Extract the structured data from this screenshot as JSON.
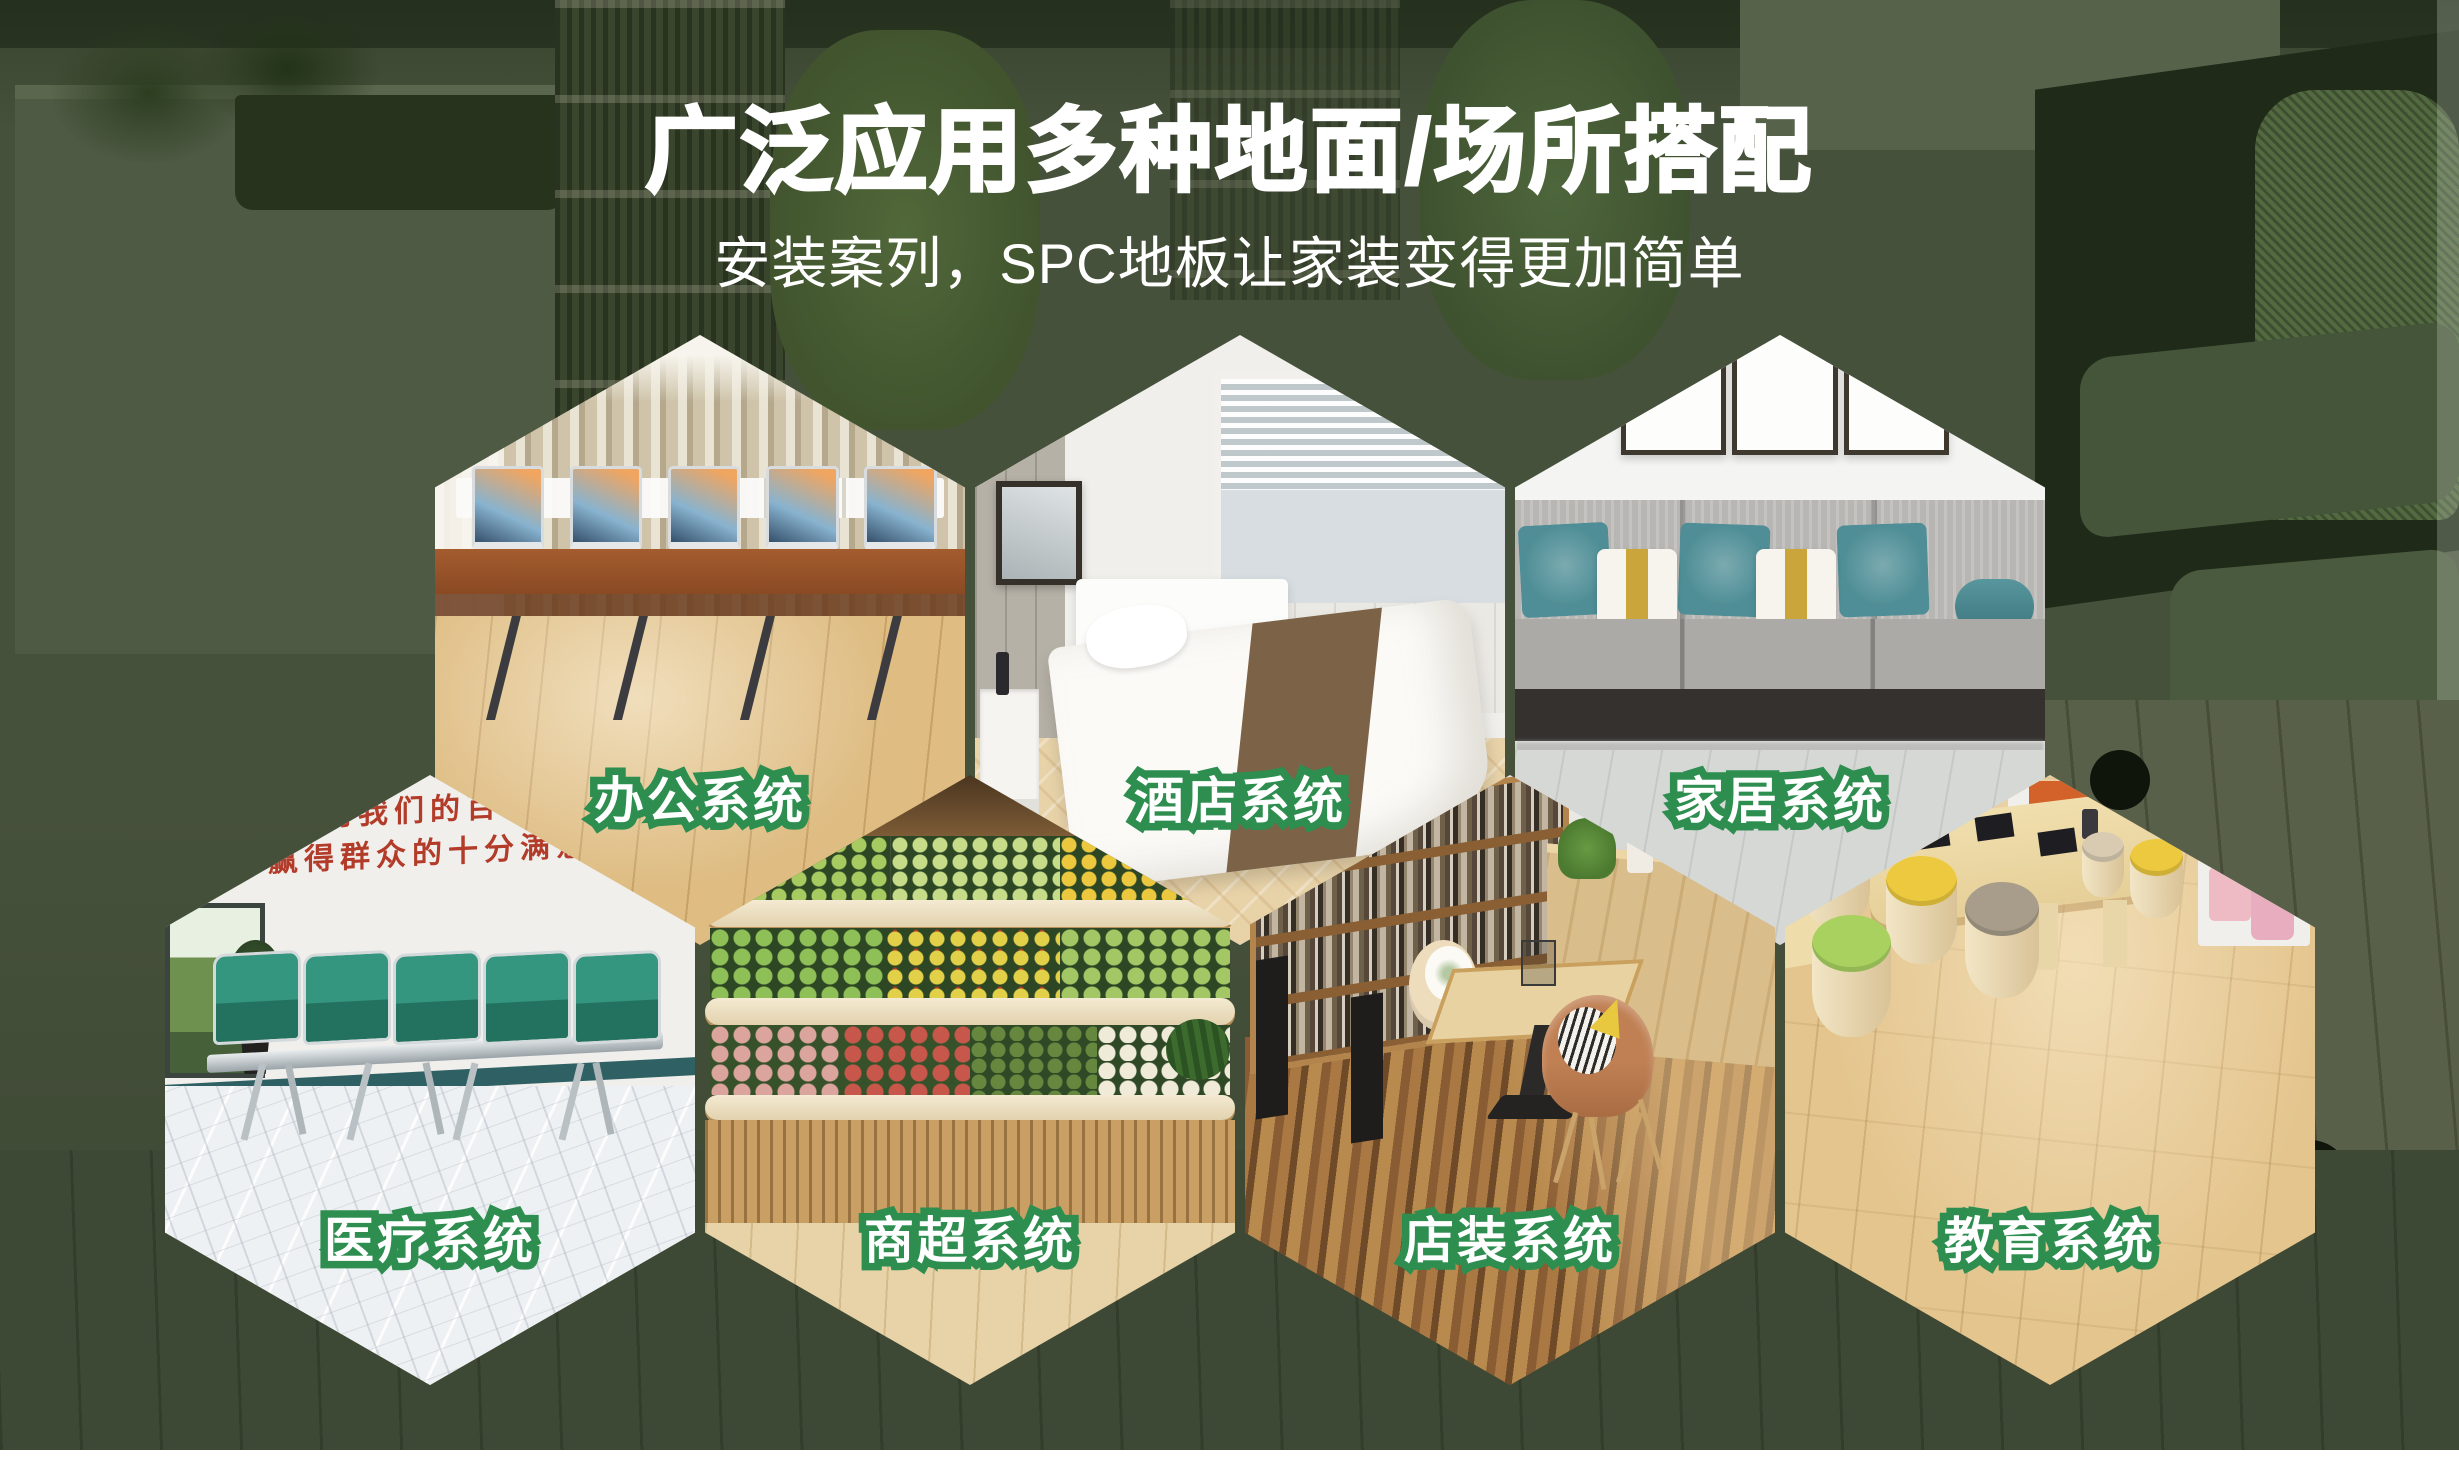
{
  "poster": {
    "title": "广泛应用多种地面/场所搭配",
    "subtitle": "安装案列，SPC地板让家装变得更加简单",
    "colors": {
      "background_green": "#46513b",
      "label_outline_green": "#2d8e50",
      "label_fill": "#ffffff",
      "title_color": "#ffffff",
      "medical_wall_text_red": "#b33b29"
    },
    "scenes": [
      {
        "id": "office",
        "label": "办公系统"
      },
      {
        "id": "hotel",
        "label": "酒店系统"
      },
      {
        "id": "home",
        "label": "家居系统"
      },
      {
        "id": "medical",
        "label": "医疗系统",
        "wall_text_line1": "用我们的百倍",
        "wall_text_line2": "赢得群众的十分满意"
      },
      {
        "id": "supermarket",
        "label": "商超系统"
      },
      {
        "id": "store",
        "label": "店装系统"
      },
      {
        "id": "education",
        "label": "教育系统"
      }
    ]
  }
}
